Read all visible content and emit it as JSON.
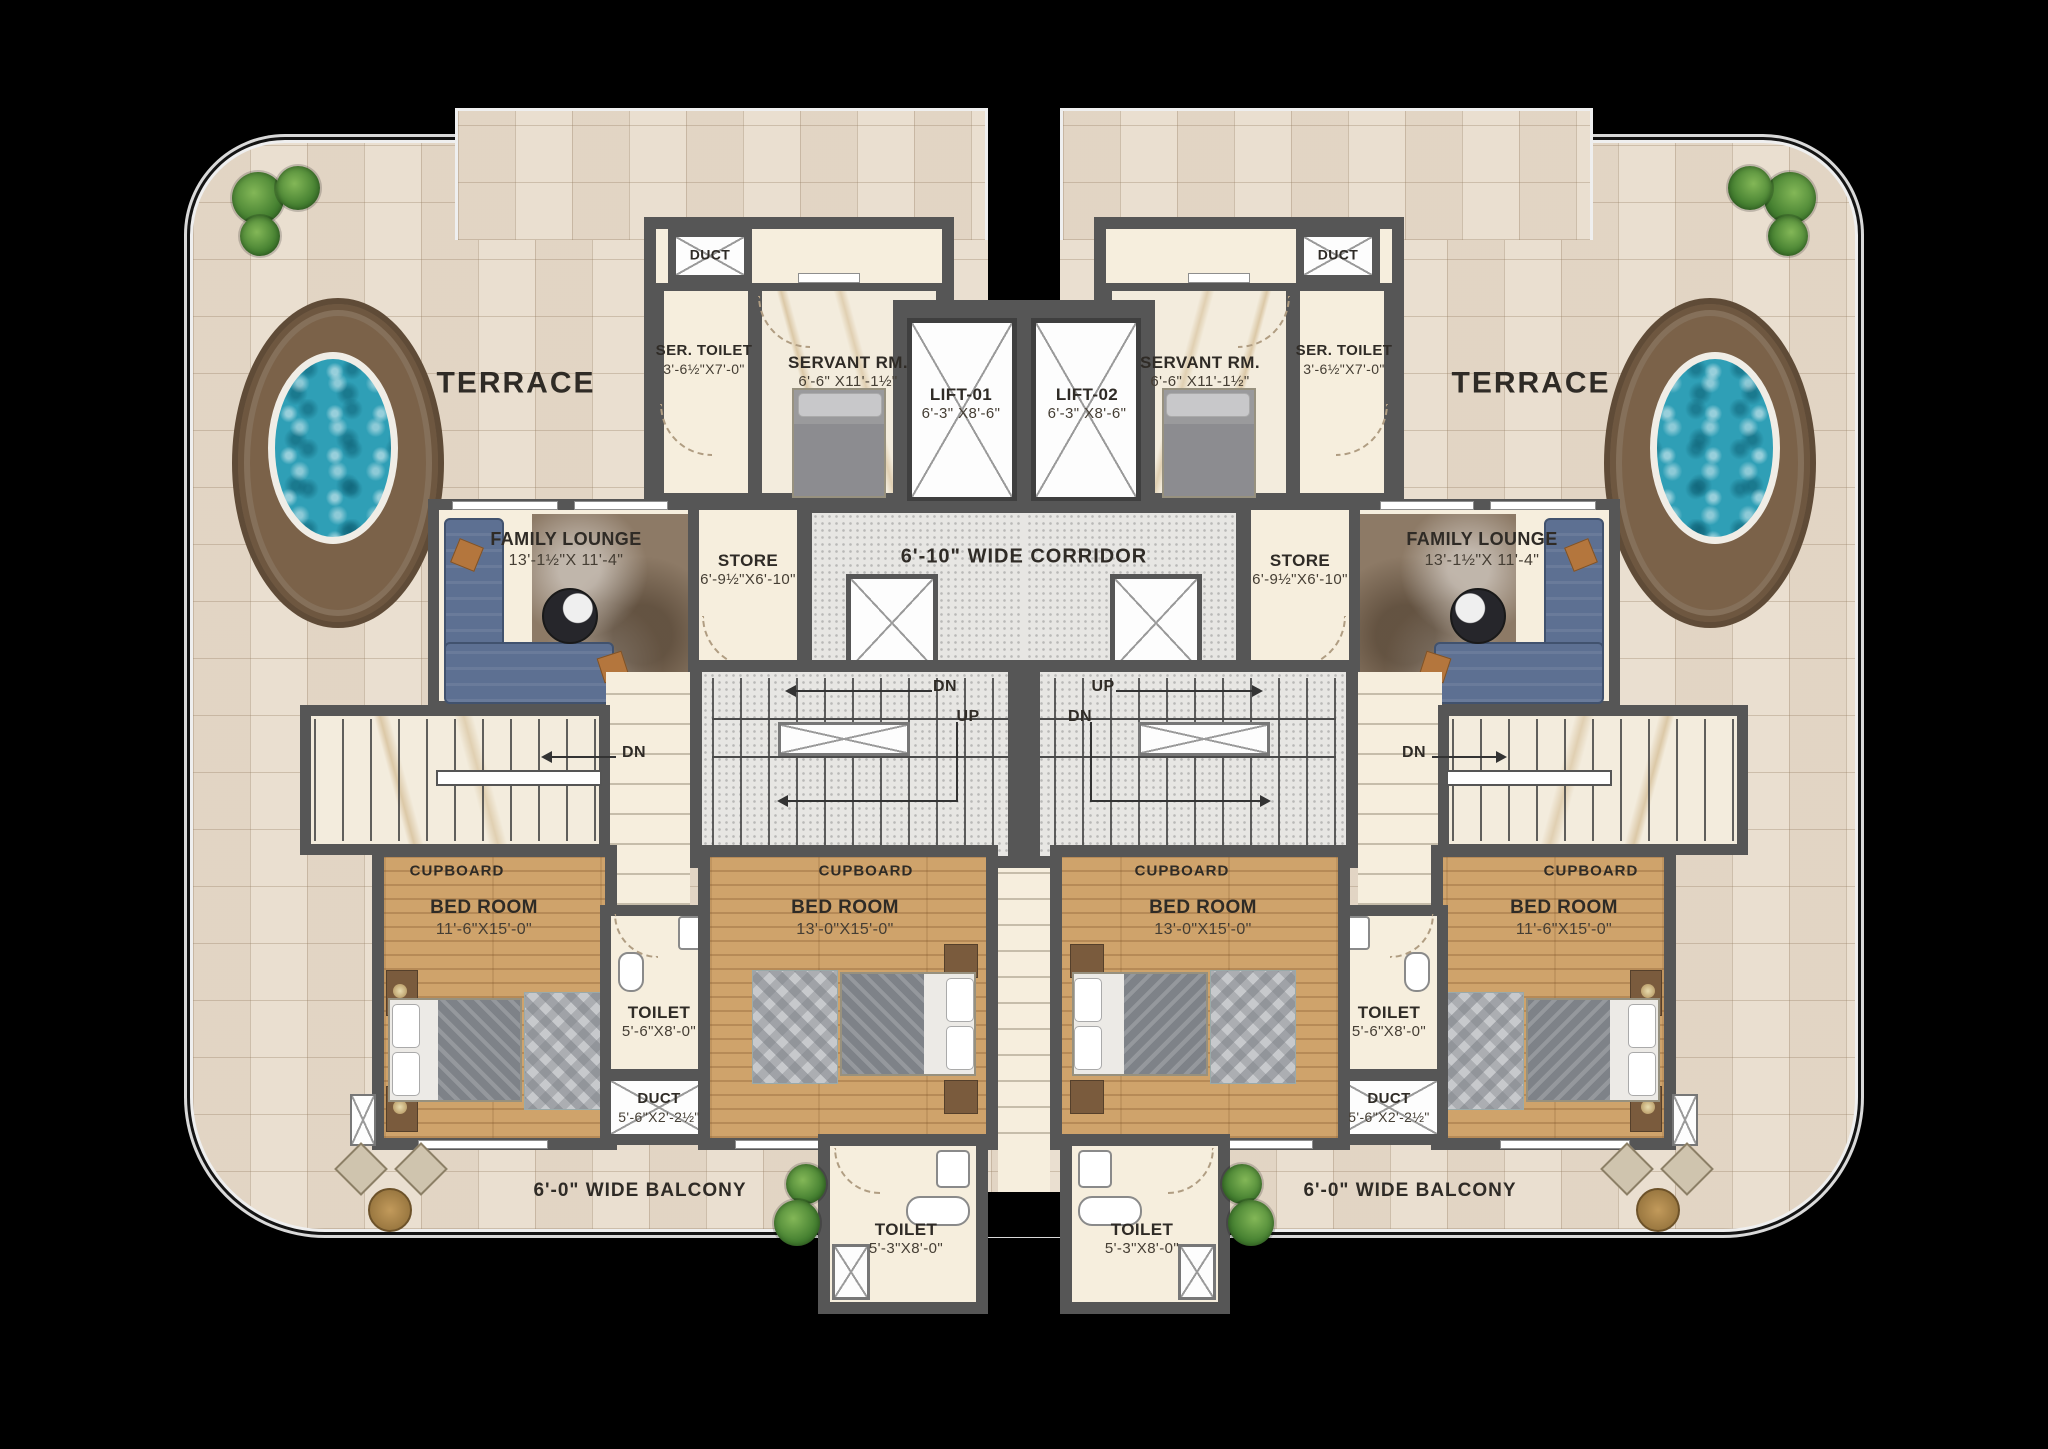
{
  "plan_type": "residential floor plan",
  "labels": {
    "terrace": "TERRACE",
    "corridor": "6'-10\" WIDE CORRIDOR",
    "balcony": "6'-0\" WIDE BALCONY",
    "cupboard": "CUPBOARD",
    "up": "UP",
    "dn": "DN"
  },
  "rooms": {
    "duct_top": {
      "name": "DUCT"
    },
    "ser_toilet": {
      "name": "SER. TOILET",
      "dims": "3'-6½\"X7'-0\""
    },
    "servant": {
      "name": "SERVANT RM.",
      "dims": "6'-6\" X11'-1½\""
    },
    "lift1": {
      "name": "LIFT-01",
      "dims": "6'-3\" X8'-6\""
    },
    "lift2": {
      "name": "LIFT-02",
      "dims": "6'-3\" X8'-6\""
    },
    "family_lounge": {
      "name": "FAMILY LOUNGE",
      "dims": "13'-1½\"X 11'-4\""
    },
    "store": {
      "name": "STORE",
      "dims": "6'-9½\"X6'-10\""
    },
    "bedroom_outer": {
      "name": "BED ROOM",
      "dims": "11'-6\"X15'-0\""
    },
    "bedroom_inner": {
      "name": "BED ROOM",
      "dims": "13'-0\"X15'-0\""
    },
    "toilet_mid": {
      "name": "TOILET",
      "dims": "5'-6\"X8'-0\""
    },
    "duct_mid": {
      "name": "DUCT",
      "dims": "5'-6\"X2'-2½\""
    },
    "toilet_bottom": {
      "name": "TOILET",
      "dims": "5'-3\"X8'-0\""
    }
  },
  "colors": {
    "background": "#000000",
    "wall": "#565656",
    "terrace_tile": "#eadfd0",
    "interior_cream": "#f6eedd",
    "bedroom_wood": "#cfa36b",
    "corridor_floor": "#e7e6e3",
    "cupboard_brown": "#5f4937",
    "sofa_blue": "#5d7092",
    "pool_water": "#2f9fb6",
    "pool_deck": "#7b6249",
    "plant_green": "#447f30",
    "label_text": "#2f2b26"
  }
}
